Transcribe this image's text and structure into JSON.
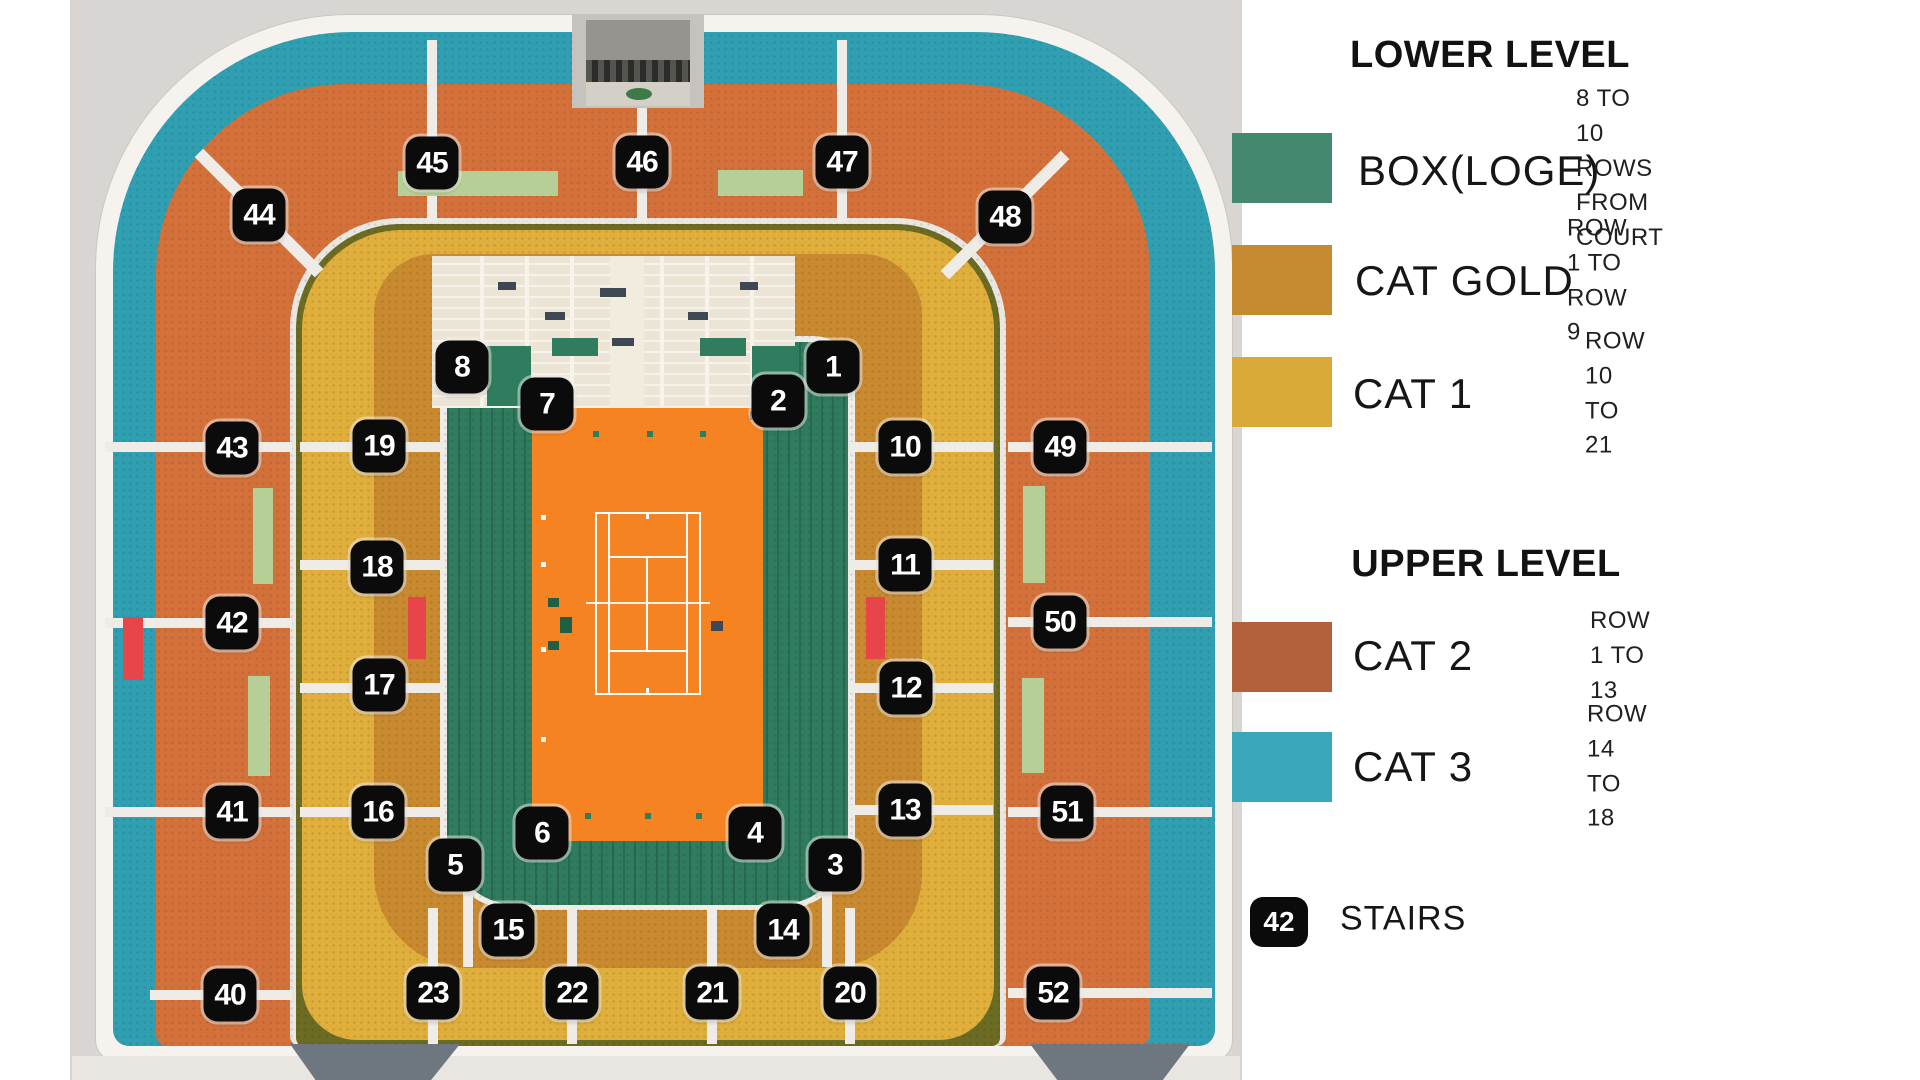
{
  "map": {
    "background_color": "#d8d5d2",
    "court_color": "#f58322",
    "badge_color": "#0b0b0b",
    "ring_colors": {
      "box_loge": "#2f7c5e",
      "cat_gold": "#c8892f",
      "cat_1": "#dfae3b",
      "cat_2": "#d4713a",
      "cat_3": "#2f9fb1"
    },
    "badges": [
      {
        "n": "45",
        "x": 432,
        "y": 163
      },
      {
        "n": "46",
        "x": 642,
        "y": 162
      },
      {
        "n": "47",
        "x": 842,
        "y": 162
      },
      {
        "n": "44",
        "x": 259,
        "y": 215
      },
      {
        "n": "48",
        "x": 1005,
        "y": 217
      },
      {
        "n": "8",
        "x": 462,
        "y": 367
      },
      {
        "n": "7",
        "x": 547,
        "y": 404
      },
      {
        "n": "2",
        "x": 778,
        "y": 401
      },
      {
        "n": "1",
        "x": 833,
        "y": 367
      },
      {
        "n": "43",
        "x": 232,
        "y": 448
      },
      {
        "n": "19",
        "x": 379,
        "y": 446
      },
      {
        "n": "18",
        "x": 377,
        "y": 567
      },
      {
        "n": "42",
        "x": 232,
        "y": 623
      },
      {
        "n": "17",
        "x": 379,
        "y": 685
      },
      {
        "n": "41",
        "x": 232,
        "y": 812
      },
      {
        "n": "16",
        "x": 378,
        "y": 812
      },
      {
        "n": "40",
        "x": 230,
        "y": 995
      },
      {
        "n": "10",
        "x": 905,
        "y": 447
      },
      {
        "n": "49",
        "x": 1060,
        "y": 447
      },
      {
        "n": "11",
        "x": 905,
        "y": 565
      },
      {
        "n": "50",
        "x": 1060,
        "y": 622
      },
      {
        "n": "12",
        "x": 906,
        "y": 688
      },
      {
        "n": "13",
        "x": 905,
        "y": 810
      },
      {
        "n": "51",
        "x": 1067,
        "y": 812
      },
      {
        "n": "52",
        "x": 1053,
        "y": 993
      },
      {
        "n": "5",
        "x": 455,
        "y": 865
      },
      {
        "n": "6",
        "x": 542,
        "y": 833
      },
      {
        "n": "4",
        "x": 755,
        "y": 833
      },
      {
        "n": "3",
        "x": 835,
        "y": 865
      },
      {
        "n": "15",
        "x": 508,
        "y": 930
      },
      {
        "n": "14",
        "x": 783,
        "y": 930
      },
      {
        "n": "23",
        "x": 433,
        "y": 993
      },
      {
        "n": "22",
        "x": 572,
        "y": 993
      },
      {
        "n": "21",
        "x": 712,
        "y": 993
      },
      {
        "n": "20",
        "x": 850,
        "y": 993
      }
    ]
  },
  "legend": {
    "lower": {
      "title": "LOWER LEVEL",
      "rows": [
        {
          "label": "BOX(LOGE)",
          "note": "8 TO 10 ROWS\nFROM COURT",
          "color": "#44886e"
        },
        {
          "label": "CAT GOLD",
          "note": "ROW 1 TO ROW 9",
          "color": "#c5892f"
        },
        {
          "label": "CAT 1",
          "note": "ROW 10 TO 21",
          "color": "#d9aa39"
        }
      ]
    },
    "upper": {
      "title": "UPPER LEVEL",
      "rows": [
        {
          "label": "CAT 2",
          "note": "ROW 1 TO 13",
          "color": "#b2613c"
        },
        {
          "label": "CAT 3",
          "note": "ROW 14 TO 18",
          "color": "#3ba7ba"
        }
      ]
    },
    "stairs": {
      "badge": "42",
      "label": "STAIRS"
    }
  }
}
